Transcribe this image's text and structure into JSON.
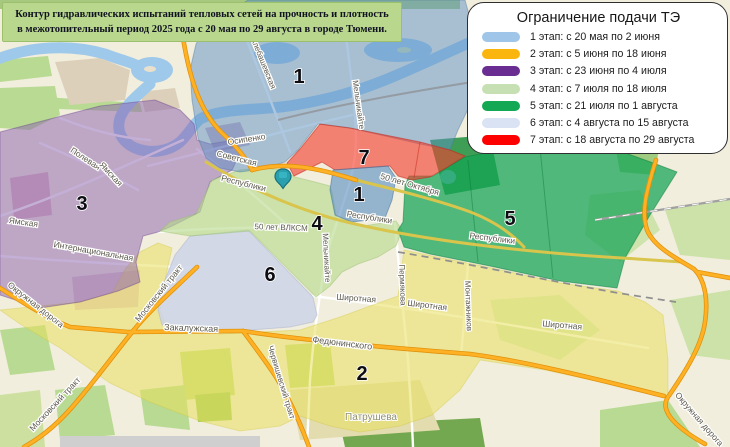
{
  "title": {
    "line1": "Контур гидравлических испытаний тепловых сетей на прочность и плотность",
    "line2": "в межотопительный период 2025 года с 20 мая по 29 августа в городе Тюмени."
  },
  "legend": {
    "title": "Ограничение подачи ТЭ",
    "items": [
      {
        "color": "#9fc5e8",
        "label": "1 этап: с 20 мая по 2 июня"
      },
      {
        "color": "#fbb50f",
        "label": "2 этап: с 5 июня по 18 июня"
      },
      {
        "color": "#6a2d91",
        "label": "3 этап: с 23 июня по 4 июля"
      },
      {
        "color": "#c6e0b4",
        "label": "4 этап: с 7 июля по 18 июля"
      },
      {
        "color": "#15a854",
        "label": "5 этап: с 21 июля по 1 августа"
      },
      {
        "color": "#dae3f3",
        "label": "6 этап: с 4 августа по 15 августа"
      },
      {
        "color": "#fd0000",
        "label": "7 этап: с 18 августа по 29 августа"
      }
    ]
  },
  "map": {
    "zone_numbers": [
      {
        "n": "1",
        "x": 299,
        "y": 83
      },
      {
        "n": "7",
        "x": 364,
        "y": 164
      },
      {
        "n": "1",
        "x": 359,
        "y": 201
      },
      {
        "n": "3",
        "x": 82,
        "y": 210
      },
      {
        "n": "4",
        "x": 317,
        "y": 230
      },
      {
        "n": "5",
        "x": 510,
        "y": 225
      },
      {
        "n": "6",
        "x": 270,
        "y": 281
      },
      {
        "n": "2",
        "x": 362,
        "y": 380
      }
    ],
    "street_labels": [
      {
        "t": "Алебашевская",
        "x": 261,
        "y": 64,
        "r": 68,
        "s": 8
      },
      {
        "t": "Мельникайте",
        "x": 356,
        "y": 105,
        "r": 82,
        "s": 8
      },
      {
        "t": "Осипенко",
        "x": 247,
        "y": 142,
        "r": -9,
        "s": 8.5
      },
      {
        "t": "Советская",
        "x": 236,
        "y": 161,
        "r": 14,
        "s": 8.5
      },
      {
        "t": "Республики",
        "x": 243,
        "y": 186,
        "r": 14,
        "s": 8.5
      },
      {
        "t": "Республики",
        "x": 369,
        "y": 220,
        "r": 9,
        "s": 8.5,
        "c": "#3f6db0"
      },
      {
        "t": "Республики",
        "x": 492,
        "y": 241,
        "r": 7,
        "s": 8.5
      },
      {
        "t": "50 лет Октября",
        "x": 409,
        "y": 187,
        "r": 16,
        "s": 8.5
      },
      {
        "t": "50 лет ВЛКСМ",
        "x": 281,
        "y": 230,
        "r": 2,
        "s": 8,
        "c": "#a9a99b"
      },
      {
        "t": "Мельникайте",
        "x": 324,
        "y": 258,
        "r": 87,
        "s": 8
      },
      {
        "t": "Пермякова",
        "x": 400,
        "y": 285,
        "r": 88,
        "s": 8
      },
      {
        "t": "Монтажников",
        "x": 466,
        "y": 306,
        "r": 88,
        "s": 8
      },
      {
        "t": "Полевая",
        "x": 84,
        "y": 161,
        "r": 33,
        "s": 8.5
      },
      {
        "t": "Ямская",
        "x": 109,
        "y": 176,
        "r": 47,
        "s": 8.5
      },
      {
        "t": "Ямская",
        "x": 23,
        "y": 225,
        "r": 8,
        "s": 8.5
      },
      {
        "t": "Интернациональная",
        "x": 93,
        "y": 254,
        "r": 10,
        "s": 8.5
      },
      {
        "t": "Московский тракт",
        "x": 161,
        "y": 295,
        "r": -51,
        "s": 8.5
      },
      {
        "t": "Московский тракт",
        "x": 57,
        "y": 406,
        "r": -47,
        "s": 8.5
      },
      {
        "t": "Окружная дорога",
        "x": 34,
        "y": 307,
        "r": 38,
        "s": 8.5
      },
      {
        "t": "Закалужская",
        "x": 191,
        "y": 331,
        "r": 2,
        "s": 9
      },
      {
        "t": "Федюнинского",
        "x": 342,
        "y": 346,
        "r": 7,
        "s": 9
      },
      {
        "t": "Червишевский тракт",
        "x": 279,
        "y": 383,
        "r": 73,
        "s": 8
      },
      {
        "t": "Широтная",
        "x": 356,
        "y": 301,
        "r": 4,
        "s": 8.5
      },
      {
        "t": "Широтная",
        "x": 427,
        "y": 308,
        "r": 7,
        "s": 8.5
      },
      {
        "t": "Широтная",
        "x": 562,
        "y": 328,
        "r": 5,
        "s": 8.5
      },
      {
        "t": "Окружная дорога",
        "x": 697,
        "y": 421,
        "r": 49,
        "s": 8.5
      }
    ],
    "place_labels": [
      {
        "t": "Патрушева",
        "x": 371,
        "y": 420,
        "s": 10
      }
    ]
  }
}
